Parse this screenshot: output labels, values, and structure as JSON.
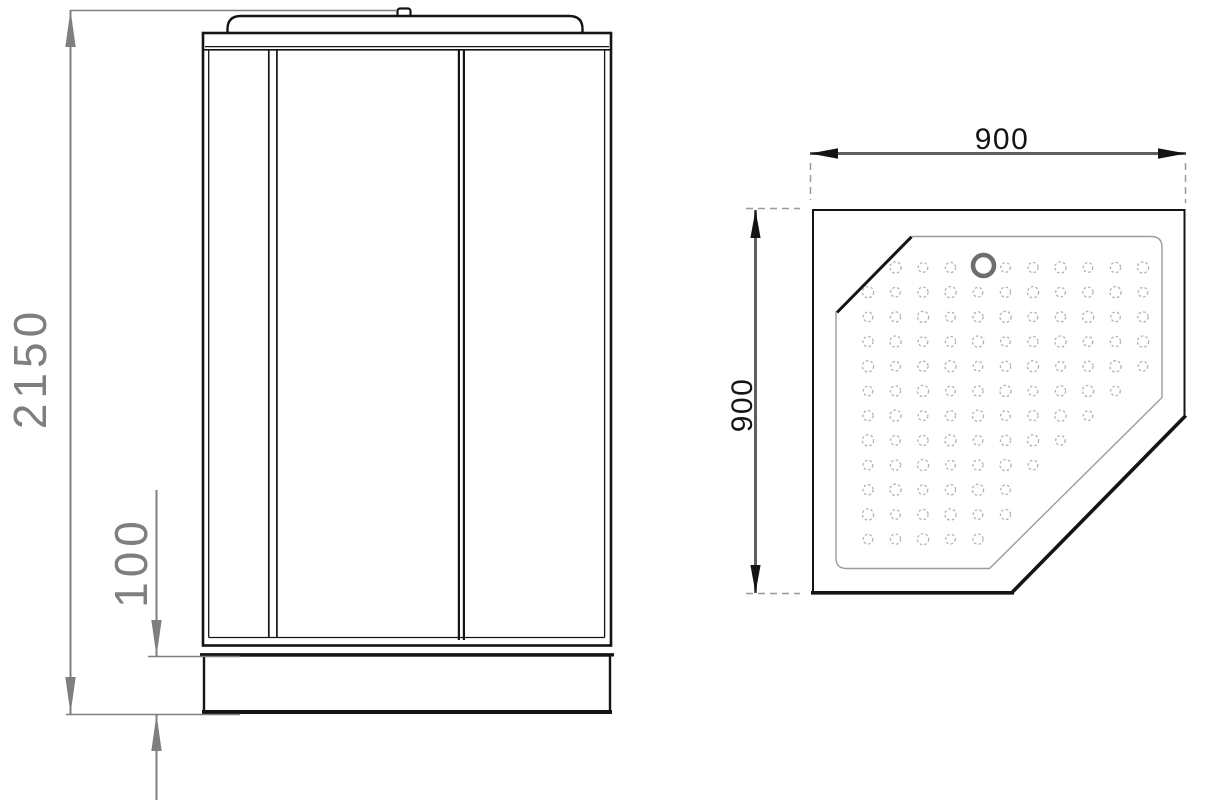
{
  "drawing": {
    "type": "technical-dimension-drawing",
    "subject": "corner shower cabin with pentagonal tray",
    "front_view": {
      "height_label": "2150",
      "base_height_label": "100"
    },
    "top_view": {
      "width_label": "900",
      "depth_label": "900",
      "dot_grid": {
        "x0": 868,
        "y0": 267.5,
        "dx": 27.5,
        "dy": 24.7,
        "cols": 11,
        "rows": 12,
        "min_sum": 1156,
        "max_sum": 1521,
        "right_max": 1148,
        "drain_x": 983.5,
        "drain_y": 265.5,
        "drain_clear": 17
      }
    },
    "colors": {
      "bg": "#ffffff",
      "line": "#141414",
      "dim_gray": "#7f7f7f",
      "dim_dark": "#5f5f5f",
      "ext_gray": "#9a9a9a",
      "inner_gray": "#9c9c9c",
      "dot_gray": "#b2b2b2",
      "drain_gray": "#6e6e6e"
    }
  }
}
